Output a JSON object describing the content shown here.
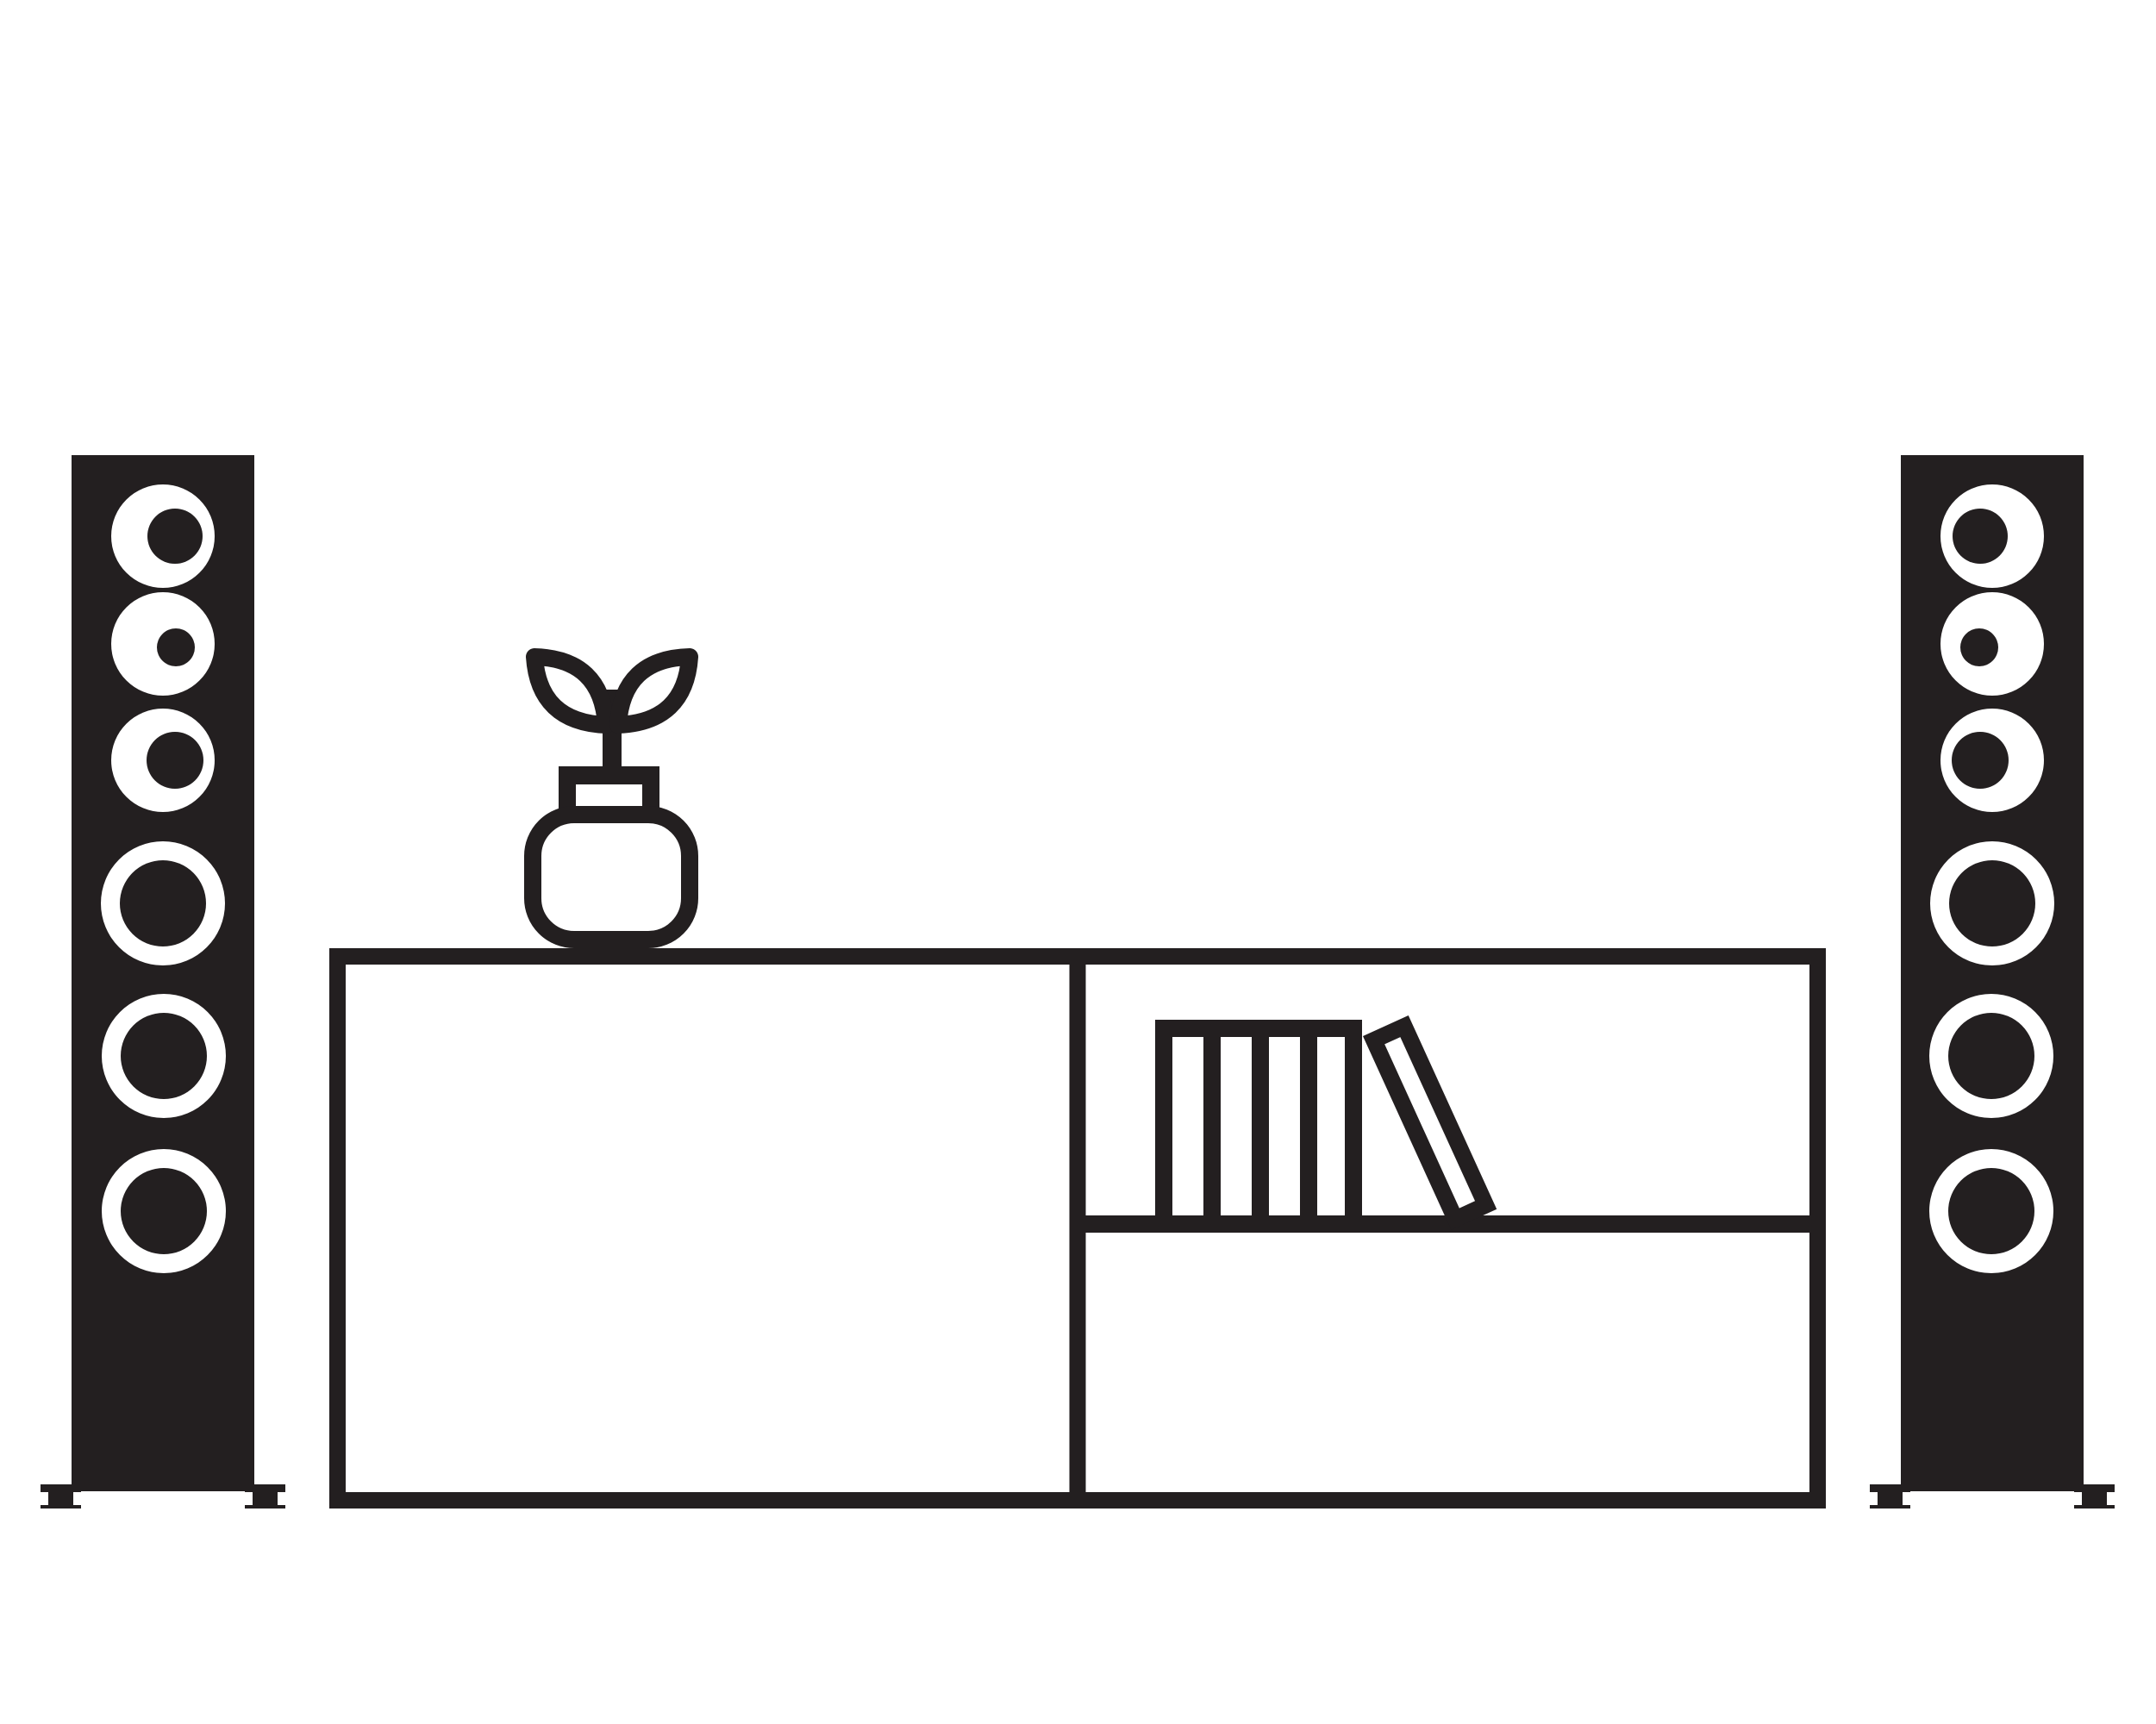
{
  "scene": {
    "title": "Living room media setup — minimal black line illustration",
    "style": "flat monochrome pictogram",
    "colors": {
      "ink": "#231f20",
      "background": "#ffffff"
    },
    "objects": {
      "left_speaker": {
        "label": "floor-standing tower speaker (left)",
        "driver_count": 6,
        "feet_count": 2
      },
      "right_speaker": {
        "label": "floor-standing tower speaker (right)",
        "driver_count": 6,
        "feet_count": 2
      },
      "tv_stand": {
        "label": "TV stand / sideboard",
        "compartments": 3,
        "shelf_count": 1
      },
      "books": {
        "label": "books on shelf",
        "standing_count": 4,
        "leaning_count": 1
      },
      "plant": {
        "label": "round vase with sprouting plant",
        "leaf_count": 2
      }
    }
  }
}
